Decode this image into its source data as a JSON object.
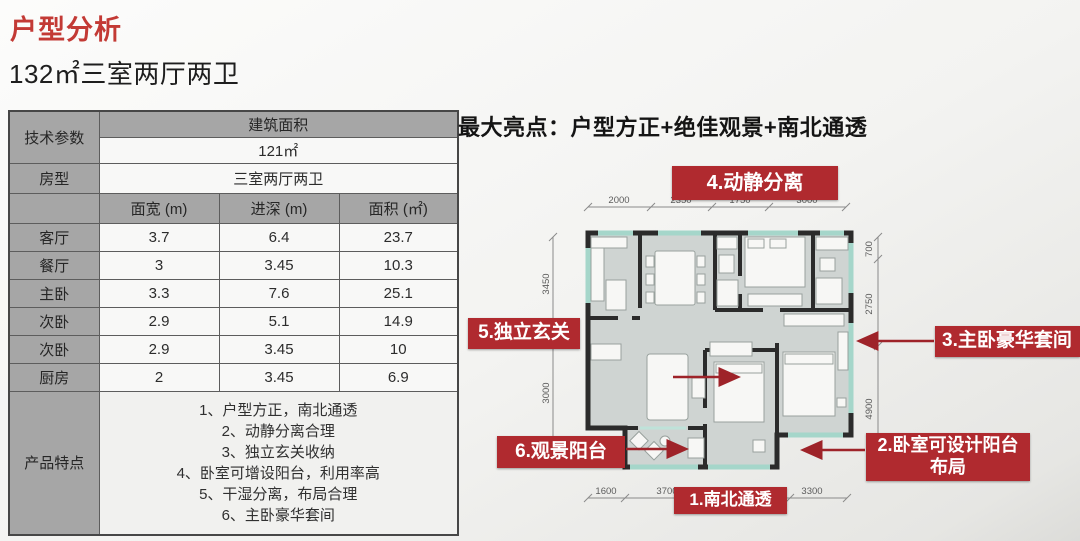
{
  "page": {
    "title": "户型分析",
    "subtitle": "132㎡三室两厅两卫"
  },
  "table": {
    "tech_param_label": "技术参数",
    "built_area_label": "建筑面积",
    "built_area_value": "121㎡",
    "house_type_label": "房型",
    "house_type_value": "三室两厅两卫",
    "col_headers": [
      "面宽 (m)",
      "进深 (m)",
      "面积 (㎡)"
    ],
    "rooms": [
      {
        "name": "客厅",
        "width": "3.7",
        "depth": "6.4",
        "area": "23.7"
      },
      {
        "name": "餐厅",
        "width": "3",
        "depth": "3.45",
        "area": "10.3"
      },
      {
        "name": "主卧",
        "width": "3.3",
        "depth": "7.6",
        "area": "25.1"
      },
      {
        "name": "次卧",
        "width": "2.9",
        "depth": "5.1",
        "area": "14.9"
      },
      {
        "name": "次卧",
        "width": "2.9",
        "depth": "3.45",
        "area": "10"
      },
      {
        "name": "厨房",
        "width": "2",
        "depth": "3.45",
        "area": "6.9"
      }
    ],
    "features_label": "产品特点",
    "features": [
      "1、户型方正，南北通透",
      "2、动静分离合理",
      "3、独立玄关收纳",
      "4、卧室可增设阳台，利用率高",
      "5、干湿分离，布局合理",
      "6、主卧豪华套间"
    ]
  },
  "right": {
    "headline": "最大亮点：户型方正+绝佳观景+南北通透",
    "callouts": {
      "c1": "1.南北通透",
      "c2_line1": "2.卧室可设计阳台",
      "c2_line2": "布局",
      "c3": "3.主卧豪华套间",
      "c4": "4.动静分离",
      "c5": "5.独立玄关",
      "c6": "6.观景阳台"
    },
    "dimensions": {
      "top": [
        "2000",
        "2350",
        "1750",
        "3000"
      ],
      "left": [
        "3450",
        "3000"
      ],
      "right": [
        "700",
        "2750",
        "4900"
      ],
      "bottom": [
        "1600",
        "3700",
        "3300"
      ]
    }
  },
  "colors": {
    "accent_red": "#b02a2f",
    "title_red": "#c33a35",
    "floor_gray": "#cfd4d2",
    "wall_black": "#2b2b2b",
    "window_teal": "#a5d6ca"
  }
}
